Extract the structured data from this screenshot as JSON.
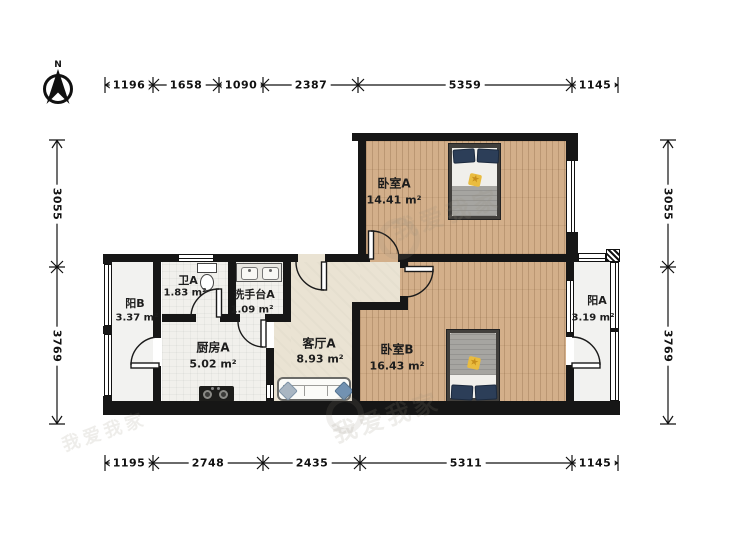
{
  "north_label": "N",
  "watermark": "我爱我家",
  "rooms": {
    "bedroomA": {
      "name": "卧室A",
      "area": "14.41 m²"
    },
    "bedroomB": {
      "name": "卧室B",
      "area": "16.43 m²"
    },
    "living": {
      "name": "客厅A",
      "area": "8.93 m²"
    },
    "kitchen": {
      "name": "厨房A",
      "area": "5.02 m²"
    },
    "washbasin": {
      "name": "洗手台A",
      "area": "1.09 m²"
    },
    "bath": {
      "name": "卫A",
      "area": "1.83 m²"
    },
    "balconyB": {
      "name": "阳B",
      "area": "3.37 m²"
    },
    "balconyA": {
      "name": "阳A",
      "area": "3.19 m²"
    }
  },
  "dimensions": {
    "top": [
      "1196",
      "1658",
      "1090",
      "2387",
      "5359",
      "1145"
    ],
    "bottom": [
      "1195",
      "2748",
      "2435",
      "5311",
      "1145"
    ],
    "left": [
      "3055",
      "3769"
    ],
    "right": [
      "3055",
      "3769"
    ]
  },
  "colors": {
    "wall": "#161616",
    "wood_floor": "#d3af8a",
    "hall_floor": "#eae3d3",
    "tile_floor": "#f1f0ec",
    "pillow_navy": "#2c3e58",
    "star_yellow": "#e9bc3f",
    "cushion_blue": "#7292b2"
  }
}
